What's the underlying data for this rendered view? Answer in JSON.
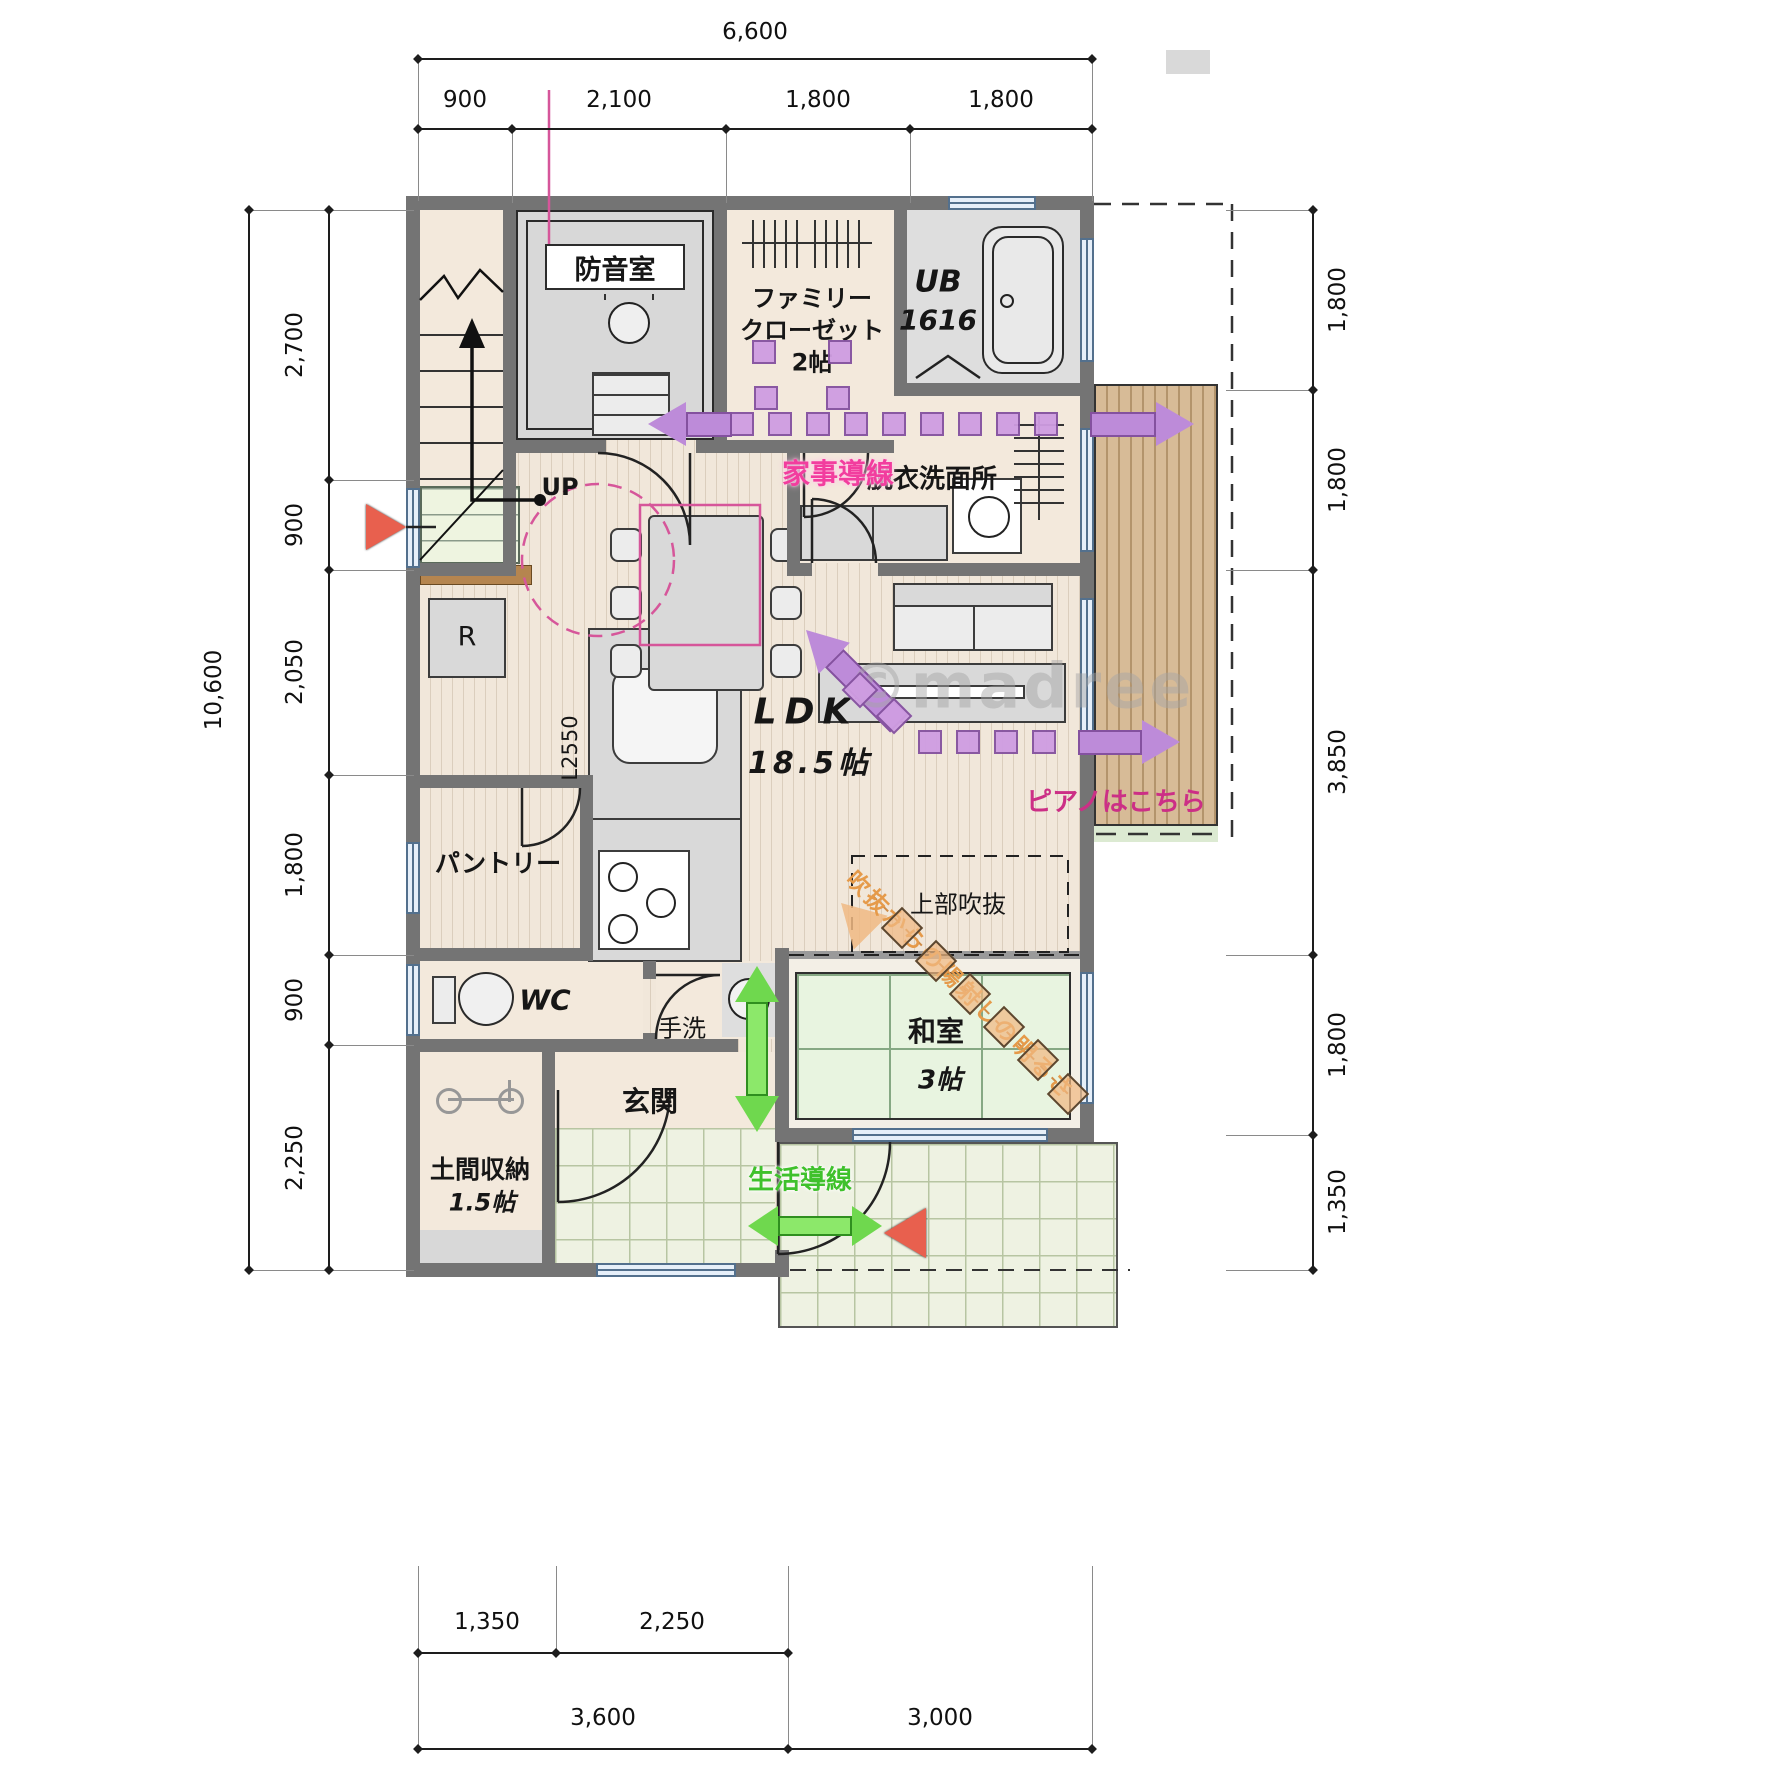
{
  "watermark": "©madree",
  "dimensions": {
    "top": {
      "total": "6,600",
      "segments": [
        "900",
        "2,100",
        "1,800",
        "1,800"
      ]
    },
    "left": {
      "total": "10,600",
      "segments": [
        "2,700",
        "900",
        "2,050",
        "1,800",
        "900",
        "2,250"
      ]
    },
    "right": {
      "segments": [
        "1,800",
        "1,800",
        "3,850",
        "1,800",
        "1,350"
      ]
    },
    "bottom": {
      "upper": [
        "1,350",
        "2,250"
      ],
      "lower": [
        "3,600",
        "3,000"
      ]
    }
  },
  "rooms": {
    "soundproof": {
      "label": "防音室"
    },
    "family_closet": {
      "line1": "ファミリー",
      "line2": "クローゼット",
      "line3": "2帖"
    },
    "unit_bath": {
      "line1": "UB",
      "line2": "1616"
    },
    "washroom": {
      "label": "脱衣洗面所"
    },
    "ldk": {
      "line1": "LDK",
      "line2": "18.5帖"
    },
    "kitchen": {
      "length_label": "L2550"
    },
    "fridge": {
      "label": "R"
    },
    "pantry": {
      "label": "パントリー"
    },
    "wc": {
      "label": "WC"
    },
    "hand_wash": {
      "label": "手洗"
    },
    "entrance": {
      "label": "玄関"
    },
    "doma_storage": {
      "line1": "土間収納",
      "line2": "1.5帖"
    },
    "washitsu": {
      "line1": "和室",
      "line2": "3帖"
    },
    "void": {
      "label": "上部吹抜"
    },
    "stairs": {
      "up_label": "UP"
    }
  },
  "flow_lines": {
    "housework": {
      "label": "家事導線",
      "color": "#f23d9e"
    },
    "living": {
      "label": "生活導線",
      "color": "#3fc12c"
    },
    "piano": {
      "label": "ピアノはこちら",
      "color": "#cc2f86"
    },
    "sunlight": {
      "label": "吹抜からの陽射しの明るさ",
      "color": "#e59a4a"
    }
  },
  "colors": {
    "wall": "#747474",
    "route_purple": "#bd8bd9",
    "route_green": "#8ce86a",
    "route_orange": "#f0b982",
    "arrow_red": "#e8604e",
    "accent_pink": "#d6569a"
  }
}
